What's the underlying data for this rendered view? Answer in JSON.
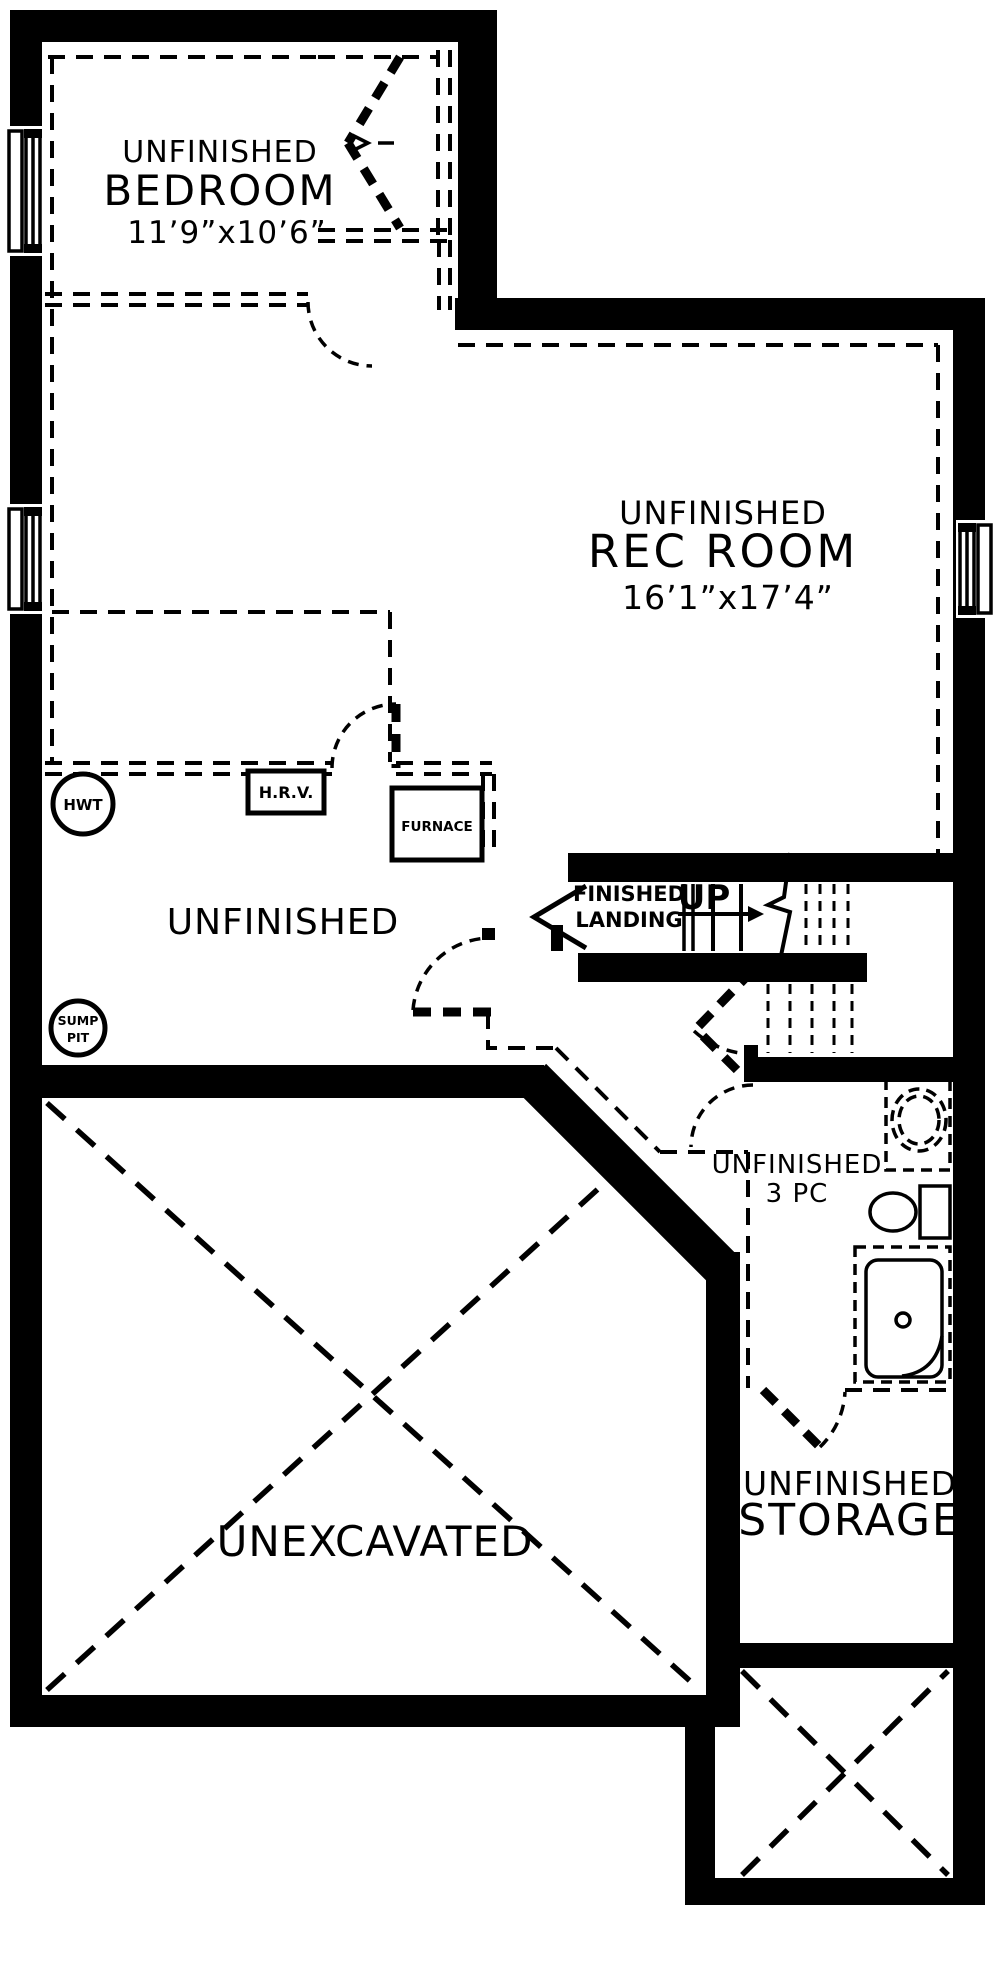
{
  "plan": {
    "bg": "#ffffff",
    "ink": "#000000",
    "rooms": {
      "bedroom": {
        "line1": "UNFINISHED",
        "line2": "BEDROOM",
        "dims": "11’9”x10’6”"
      },
      "main": {
        "dims": "14’5”x13’1”"
      },
      "rec": {
        "line1": "UNFINISHED",
        "line2": "REC ROOM",
        "dims": "16’1”x17’4”"
      },
      "utility": {
        "label": "UNFINISHED"
      },
      "bath": {
        "line1": "UNFINISHED",
        "line2": "3 PC"
      },
      "unexcavated": {
        "label": "UNEXCAVATED"
      },
      "storage": {
        "line1": "UNFINISHED",
        "line2": "STORAGE"
      }
    },
    "stairs": {
      "landing_line1": "FINISHED",
      "landing_line2": "LANDING",
      "up": "UP"
    },
    "equipment": {
      "hwt": "HWT",
      "hrv": "H.R.V.",
      "furnace": "FURNACE",
      "sump_line1": "SUMP",
      "sump_line2": "PIT"
    }
  }
}
